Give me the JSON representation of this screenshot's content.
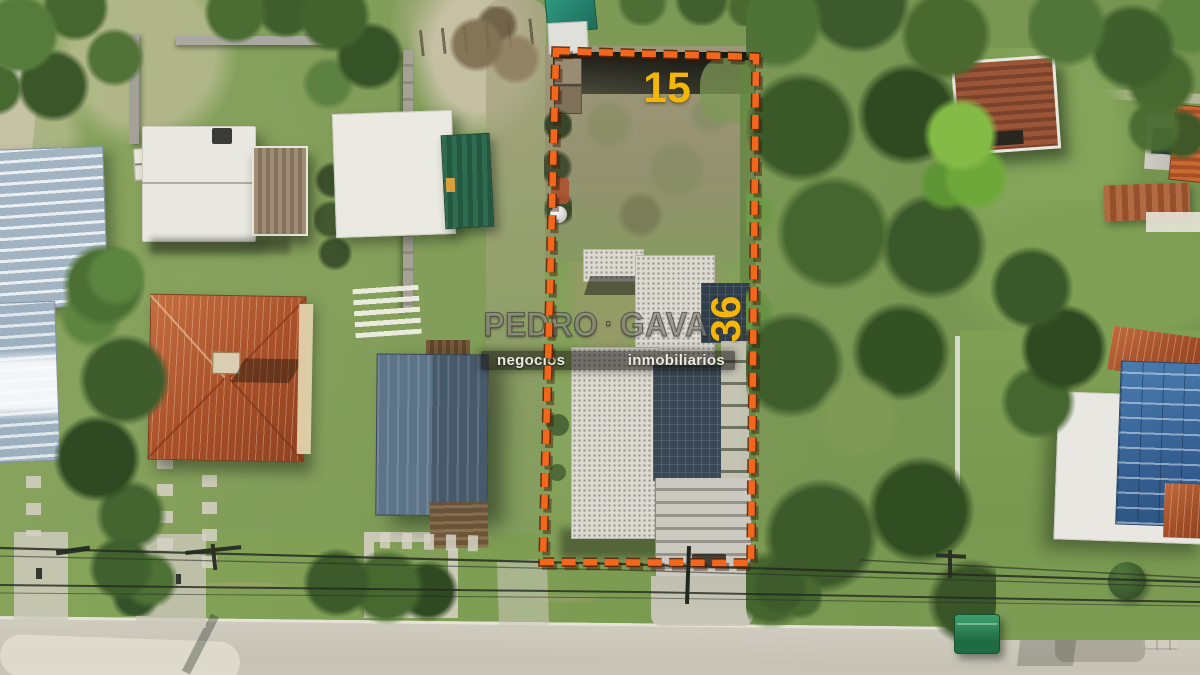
{
  "image_type": "aerial-drone-photo-real-estate-lot",
  "overlay": {
    "front_width_label": "15",
    "side_depth_label": "36"
  },
  "watermark": {
    "brand_first": "PEDRO",
    "brand_second": "GAVA",
    "separator": "·",
    "tagline_left": "negocios",
    "tagline_right": "inmobiliarios"
  },
  "colors": {
    "boundary_orange": "#F2671C",
    "boundary_outline": "#5C2708",
    "label_yellow": "#F3B70B",
    "watermark_band": "rgba(24,22,19,0.55)",
    "watermark_text": "#ECE9E2"
  }
}
